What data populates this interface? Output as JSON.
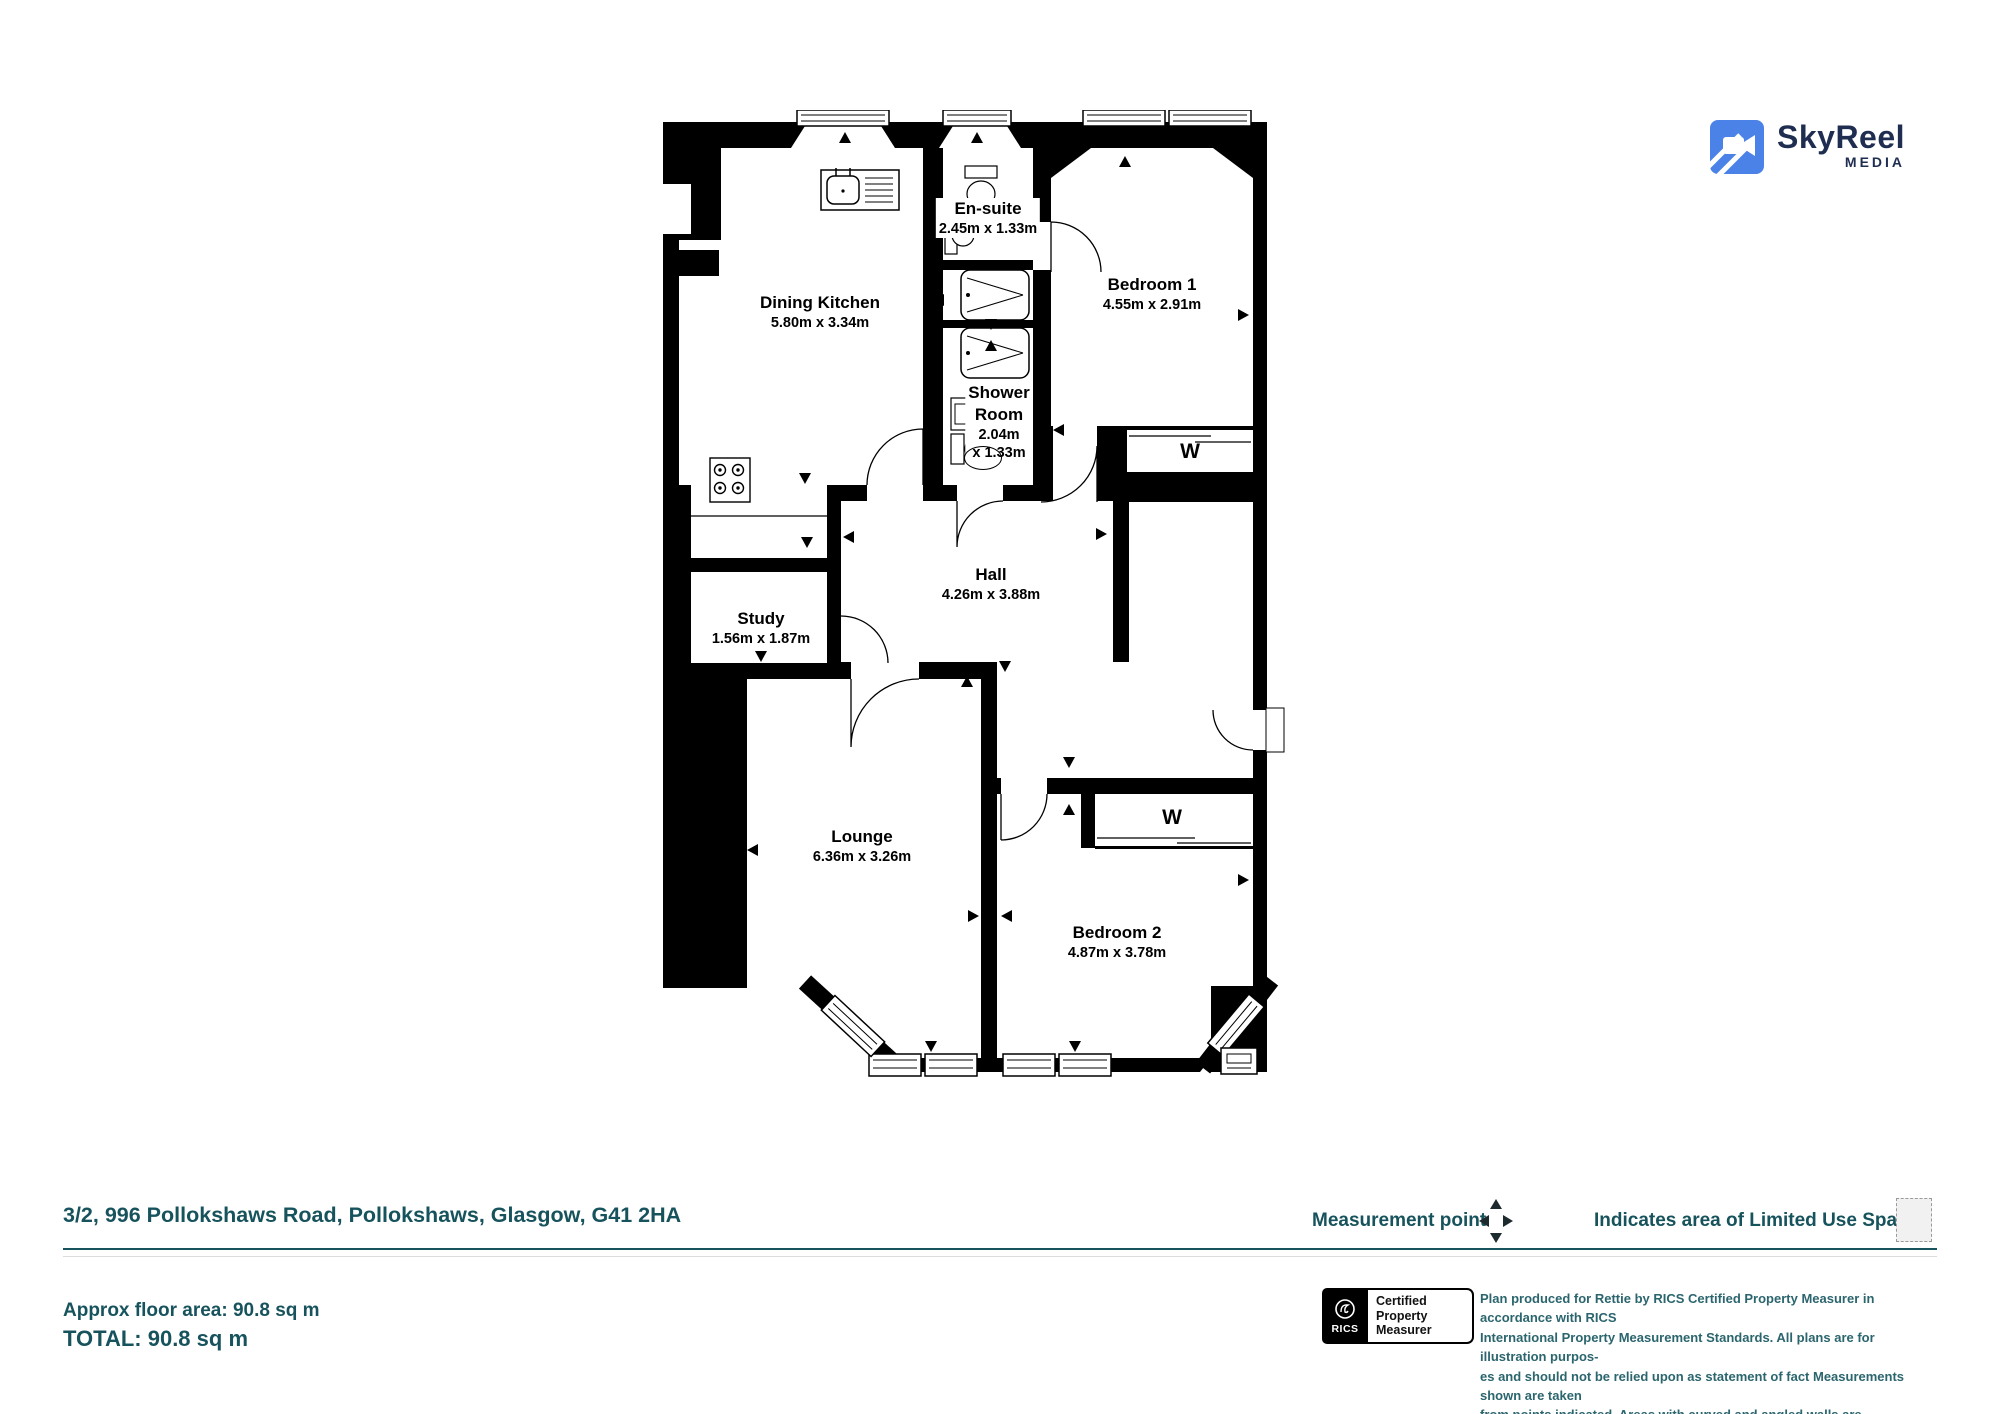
{
  "logo": {
    "brand": "SkyReel",
    "sub": "MEDIA"
  },
  "plan": {
    "wardrobe_label": "W",
    "rooms": [
      {
        "key": "dining-kitchen",
        "name": "Dining Kitchen",
        "dims": "5.80m x 3.34m"
      },
      {
        "key": "en-suite",
        "name": "En-suite",
        "dims": "2.45m x 1.33m"
      },
      {
        "key": "bedroom-1",
        "name": "Bedroom 1",
        "dims": "4.55m x 2.91m"
      },
      {
        "key": "shower-room",
        "name": "Shower Room",
        "dims": "2.04m x 1.33m",
        "line1": "Shower",
        "line2": "Room",
        "line3": "2.04m",
        "line4": "x 1.33m"
      },
      {
        "key": "hall",
        "name": "Hall",
        "dims": "4.26m x 3.88m"
      },
      {
        "key": "study",
        "name": "Study",
        "dims": "1.56m x 1.87m"
      },
      {
        "key": "lounge",
        "name": "Lounge",
        "dims": "6.36m x 3.26m"
      },
      {
        "key": "bedroom-2",
        "name": "Bedroom 2",
        "dims": "4.87m x 3.78m"
      }
    ]
  },
  "footer": {
    "address": "3/2, 996 Pollokshaws Road, Pollokshaws, Glasgow, G41 2HA",
    "measurement_point_label": "Measurement point",
    "limited_use_label": "Indicates area of Limited Use Space",
    "approx_area": "Approx floor area: 90.8 sq m",
    "total": "TOTAL: 90.8 sq m"
  },
  "rics": {
    "org": "RICS",
    "line1": "Certified",
    "line2": "Property",
    "line3": "Measurer"
  },
  "disclaimer": {
    "line1": "Plan produced for Rettie by RICS Certified Property Measurer in accordance with RICS",
    "line2": "International Property  Measurement Standards.  All plans are for illustration purpos-",
    "line3": "es and should not be relied upon as statement of fact Measurements shown are taken",
    "line4": "from points indicated. Areas with curved and angled walls are approximated."
  },
  "colors": {
    "teal": "#17535c",
    "disclaimer_teal": "#2b656e",
    "logo_blue": "#4b82e8",
    "navy": "#1f2d50",
    "plan_black": "#000000"
  }
}
